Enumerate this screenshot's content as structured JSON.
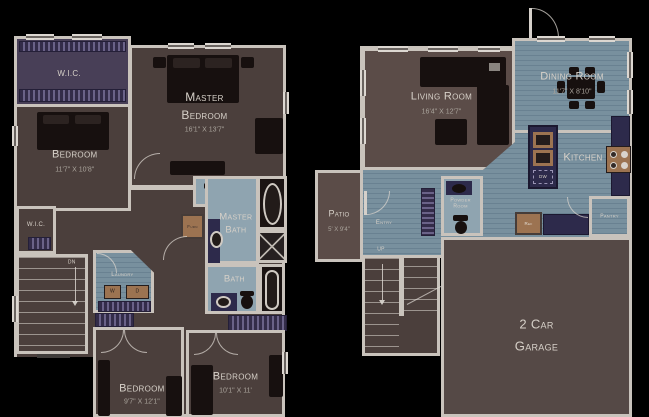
{
  "colors": {
    "background": "#000000",
    "wall": "#c9c3bc",
    "carpet": "#4b3f3c",
    "carpet_light": "#5b4c48",
    "floor_blue": "#78909e",
    "bath_blue": "#8fa4b0",
    "cabinet_navy": "#2d2a4b",
    "wood": "#9c7351",
    "furniture": "#17100f",
    "closet_purple": "#483f57",
    "text": "#d6d0c8"
  },
  "second_floor": {
    "wic_top": {
      "label": "W.I.C."
    },
    "bedroom_left": {
      "label": "Bedroom",
      "dims": "11'7\" X 10'8\""
    },
    "master_bedroom": {
      "line1": "Master",
      "line2": "Bedroom",
      "dims": "16'1\" X 13'7\""
    },
    "master_bath": {
      "line1": "Master",
      "line2": "Bath"
    },
    "furnace": {
      "label": "Furn"
    },
    "bath": {
      "label": "Bath"
    },
    "wic_small": {
      "label": "W.I.C."
    },
    "stairs_down": {
      "label": "DN"
    },
    "laundry": {
      "label": "Laundry",
      "washer": "W",
      "dryer": "D"
    },
    "bedroom_bottom_left": {
      "label": "Bedroom",
      "dims": "9'7\" X 12'1\""
    },
    "bedroom_bottom_right": {
      "label": "Bedroom",
      "dims": "10'1\" X 11'"
    }
  },
  "first_floor": {
    "living_room": {
      "label": "Living Room",
      "dims": "16'4\" X 12'7\""
    },
    "dining_room": {
      "label": "Dining Room",
      "dims": "11'7\" X 8'10\""
    },
    "kitchen": {
      "label": "Kitchen",
      "dishwasher": "DW"
    },
    "refrigerator": {
      "label": "Ref"
    },
    "pantry": {
      "label": "Pantry"
    },
    "powder_room": {
      "line1": "Powder",
      "line2": "Room"
    },
    "entry": {
      "label": "Entry"
    },
    "stairs_up": {
      "label": "UP"
    },
    "patio": {
      "label": "Patio",
      "dims": "5' X 9'4\""
    },
    "garage": {
      "line1": "2 Car",
      "line2": "Garage"
    }
  }
}
